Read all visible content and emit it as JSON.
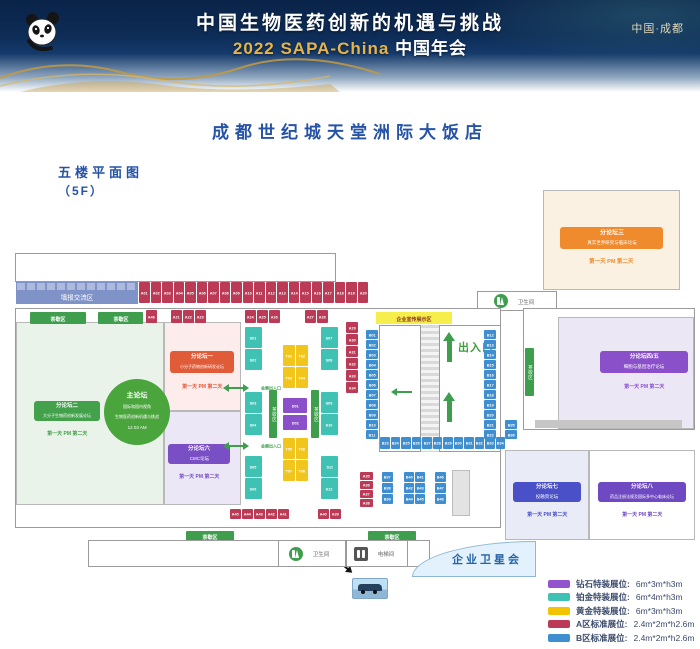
{
  "header": {
    "title_line1": "中国生物医药创新的机遇与挑战",
    "title_line2_en": "2022 SAPA-China",
    "title_line2_cn": "中国年会",
    "location": "中国·成都"
  },
  "venue": {
    "hotel": "成都世纪城天堂洲际大饭店",
    "floor_label": "五楼平面图",
    "floor_code": "（5F）"
  },
  "zones": {
    "poster": "墙报交流区",
    "tea": "茶歇区",
    "entrance_main": "出入口",
    "entrance_expo": "会展出入口",
    "promo": "企业宣传展示区",
    "satellite": "企业卫星会",
    "media": "媒体采访区",
    "restroom": "卫生间",
    "elevator": "电梯间",
    "car_display": "汽车展示区"
  },
  "forums": {
    "main": {
      "name": "主论坛",
      "line1": "国际和国内视角",
      "line2": "生物医药创新机遇与挑战",
      "time": "12.03 AM"
    },
    "f1": {
      "name": "分论坛一",
      "topic": "小分子药物创新研发论坛",
      "schedule": "第一天 PM 第二天"
    },
    "f2": {
      "name": "分论坛二",
      "topic": "大分子生物药创新发展论坛",
      "schedule": "第一天 PM 第二天"
    },
    "f3": {
      "name": "分论坛三",
      "topic": "真实世界研究与临床论坛",
      "schedule": "第一天 PM 第二天"
    },
    "f45": {
      "name": "分论坛四/五",
      "topic": "细胞与基因治疗论坛",
      "schedule": "第一天 PM 第二天"
    },
    "f6": {
      "name": "分论坛六",
      "topic": "CMC论坛",
      "schedule": "第一天 PM 第二天"
    },
    "f7": {
      "name": "分论坛七",
      "topic": "投融资论坛",
      "schedule": "第一天 PM 第二天"
    },
    "f8": {
      "name": "分论坛八",
      "topic": "药品注册法规及国际多中心临床论坛",
      "schedule": "第一天 PM 第二天"
    }
  },
  "booths": {
    "a_top": [
      "A01",
      "A02",
      "A03",
      "A04",
      "A05",
      "A06",
      "A07",
      "A08",
      "A09",
      "A10",
      "A11",
      "A12",
      "A13",
      "A14",
      "A15",
      "A16",
      "A17",
      "A18",
      "A19",
      "A20"
    ],
    "a_single": [
      "A46"
    ],
    "a_g1": [
      "A21",
      "A22",
      "A23"
    ],
    "a_g2": [
      "A24",
      "A25",
      "A26"
    ],
    "a_g3": [
      "A27",
      "A28"
    ],
    "a_col_right": [
      "A29",
      "A30",
      "A31",
      "A32",
      "A33",
      "A34"
    ],
    "a_col_bottom": [
      "A35",
      "A36",
      "A37",
      "A38"
    ],
    "a_bottom_g1": [
      "A45",
      "A44",
      "A43",
      "A42",
      "A41"
    ],
    "a_bottom_g2": [
      "A40",
      "A39"
    ],
    "s_l1": [
      "S01",
      "S02"
    ],
    "s_l2": [
      "S03",
      "S04"
    ],
    "s_l3": [
      "S05",
      "S06"
    ],
    "s_r1": [
      "S07",
      "S08"
    ],
    "s_r2": [
      "S09",
      "S10"
    ],
    "s_r3": [
      "S11",
      "S12"
    ],
    "t_top": [
      "T01",
      "T02",
      "T03",
      "T04"
    ],
    "t_bottom": [
      "T05",
      "T06",
      "T07",
      "T08"
    ],
    "d_col": [
      "D01",
      "D02"
    ],
    "b_col_left": [
      "B01",
      "B02",
      "B03",
      "B04",
      "B05",
      "B06",
      "B07",
      "B08",
      "B09",
      "B10",
      "B11"
    ],
    "b_col_right": [
      "B12",
      "B13",
      "B14",
      "B15",
      "B16",
      "B17",
      "B18",
      "B19",
      "B20",
      "B21",
      "B22"
    ],
    "b_row": [
      "B23",
      "B24",
      "B25",
      "B26",
      "B27",
      "B28",
      "B29",
      "B30",
      "B31",
      "B32",
      "B33",
      "B34"
    ],
    "b_pair": [
      "B35",
      "B36"
    ],
    "b_c1": [
      "B37",
      "B38",
      "B39"
    ],
    "b_c2": [
      "B40",
      "B41",
      "B42",
      "B43",
      "B44",
      "B45"
    ],
    "b_c3": [
      "B46",
      "B47",
      "B48"
    ]
  },
  "legend": {
    "items": [
      {
        "label": "钻石特装展位:",
        "size": "6m*3m*h3m",
        "color": "#9353cf"
      },
      {
        "label": "铂金特装展位:",
        "size": "6m*4m*h3m",
        "color": "#3fc2b4"
      },
      {
        "label": "黄金特装展位:",
        "size": "6m*3m*h3m",
        "color": "#f2c400"
      },
      {
        "label": "A区标准展位:",
        "size": "2.4m*2m*h2.6m",
        "color": "#bb3a56"
      },
      {
        "label": "B区标准展位:",
        "size": "2.4m*2m*h2.6m",
        "color": "#3e8ed0"
      }
    ]
  },
  "colors": {
    "accent_blue": "#2653a6",
    "green": "#3f9e4d",
    "zone_a": "#bb3a56",
    "zone_b": "#3e8ed0",
    "platinum": "#3fc2b4",
    "gold_booth": "#f2c51d",
    "diamond": "#8a4fc9"
  }
}
